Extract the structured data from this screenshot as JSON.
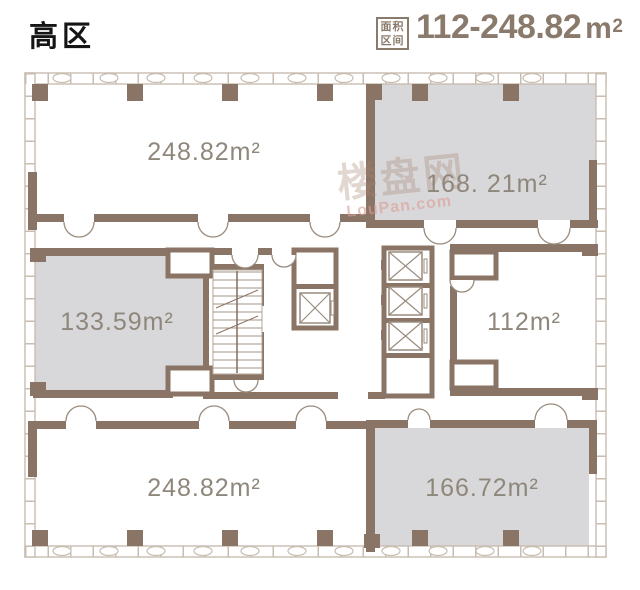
{
  "header": {
    "zone_title": "高区",
    "area_badge": {
      "line1": "面积",
      "line2": "区间"
    },
    "area_range": "112-248.82",
    "area_unit_base": "m",
    "area_unit_sup": "2"
  },
  "watermark": {
    "brand": "楼盘网",
    "domain": "LouPan.com"
  },
  "floorplan": {
    "rooms": [
      {
        "position": "top-left",
        "label": "248.82m²",
        "highlighted": false
      },
      {
        "position": "top-right",
        "label": "168. 21m²",
        "highlighted": true
      },
      {
        "position": "middle-left",
        "label": "133.59m²",
        "highlighted": true
      },
      {
        "position": "middle-right",
        "label": "112m²",
        "highlighted": false
      },
      {
        "position": "bottom-left",
        "label": "248.82m²",
        "highlighted": false
      },
      {
        "position": "bottom-right",
        "label": "166.72m²",
        "highlighted": true
      }
    ],
    "core_features": [
      "staircase",
      "elevator-x4"
    ],
    "colors": {
      "wall_brown": "#8a7466",
      "wall_light": "#c8bdb0",
      "room_highlight_fill": "#d8d8da",
      "room_label_text": "#8f877b",
      "header_accent": "#8a7a6b",
      "title_text": "#151515",
      "watermark_brand": "#a5846f",
      "watermark_domain": "#dc9e96"
    }
  }
}
